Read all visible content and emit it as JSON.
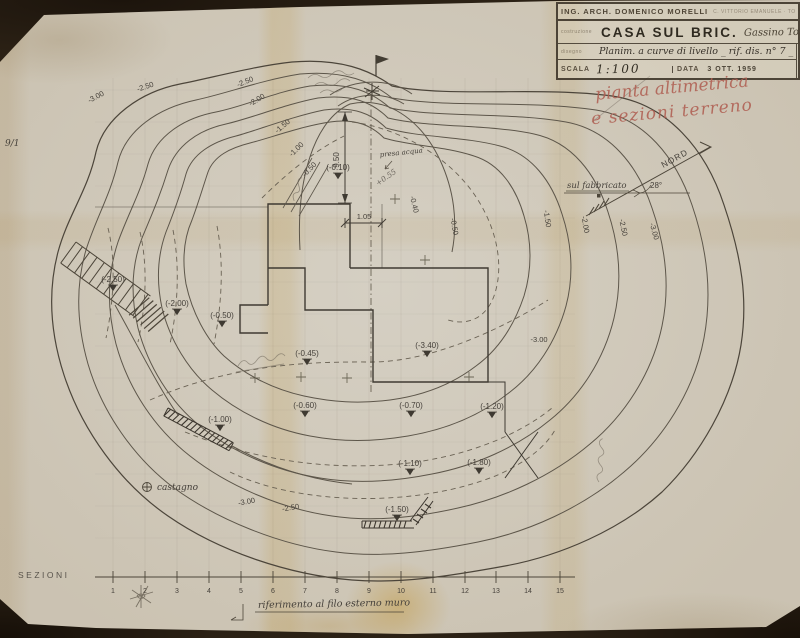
{
  "title_block": {
    "architect": "ING. ARCH. DOMENICO MORELLI",
    "architect_details": "C. VITTORIO EMANUELE · TORINO · TEL.",
    "field_label_project": "costruzione",
    "project_name": "CASA SUL BRIC.",
    "project_location": "Gassino Torinese _",
    "field_label_drawing": "disegno",
    "drawing_title": "Planim. a curve di livello _ rif. dis. n° 7 _",
    "number_label": "N°",
    "scale_label": "SCALA",
    "scale_value": "1:100",
    "date_label": "DATA",
    "date_value": "3 OTT. 1959",
    "sheet_number": "6"
  },
  "notes": {
    "red1": "pianta altimetrica",
    "red2": "e sezioni terreno",
    "north": "NORD",
    "north_angle": "28°",
    "building_ref": "sul fabbricato",
    "water": "presa acqua",
    "tree": "castagno",
    "margin": "9/1",
    "sections": "SEZIONI",
    "wall_reference": "riferimento al filo esterno muro",
    "slope": "+0.55"
  },
  "dims": {
    "vertical": "9.50",
    "horizontal": "1.05"
  },
  "spots": [
    {
      "label": "(-2.50)"
    },
    {
      "label": "(-2.00)"
    },
    {
      "label": "(-0.50)"
    },
    {
      "label": "(-0.45)"
    },
    {
      "label": "(-3.40)"
    },
    {
      "label": "(-0.60)"
    },
    {
      "label": "(-0.70)"
    },
    {
      "label": "(-1.20)"
    },
    {
      "label": "(-1.10)"
    },
    {
      "label": "(-1.80)"
    },
    {
      "label": "(-1.50)"
    },
    {
      "label": "(-1.00)"
    },
    {
      "label": "(-0.10)"
    }
  ],
  "contour_labels": [
    {
      "label": "-3.00"
    },
    {
      "label": "-2.50"
    },
    {
      "label": "-2.50"
    },
    {
      "label": "-2.00"
    },
    {
      "label": "-1.50"
    },
    {
      "label": "-1.00"
    },
    {
      "label": "-0.50"
    },
    {
      "label": "-1.50"
    },
    {
      "label": "-2.00"
    },
    {
      "label": "-2.50"
    },
    {
      "label": "-3.00"
    },
    {
      "label": "-3.00"
    },
    {
      "label": "-2.50"
    },
    {
      "label": "-3.00"
    },
    {
      "label": "-0.40"
    },
    {
      "label": "-0.50"
    }
  ],
  "scale_bar": {
    "ticks": [
      "1",
      "2",
      "3",
      "4",
      "5",
      "6",
      "7",
      "8",
      "9",
      "10",
      "11",
      "12",
      "13",
      "14",
      "15"
    ]
  }
}
